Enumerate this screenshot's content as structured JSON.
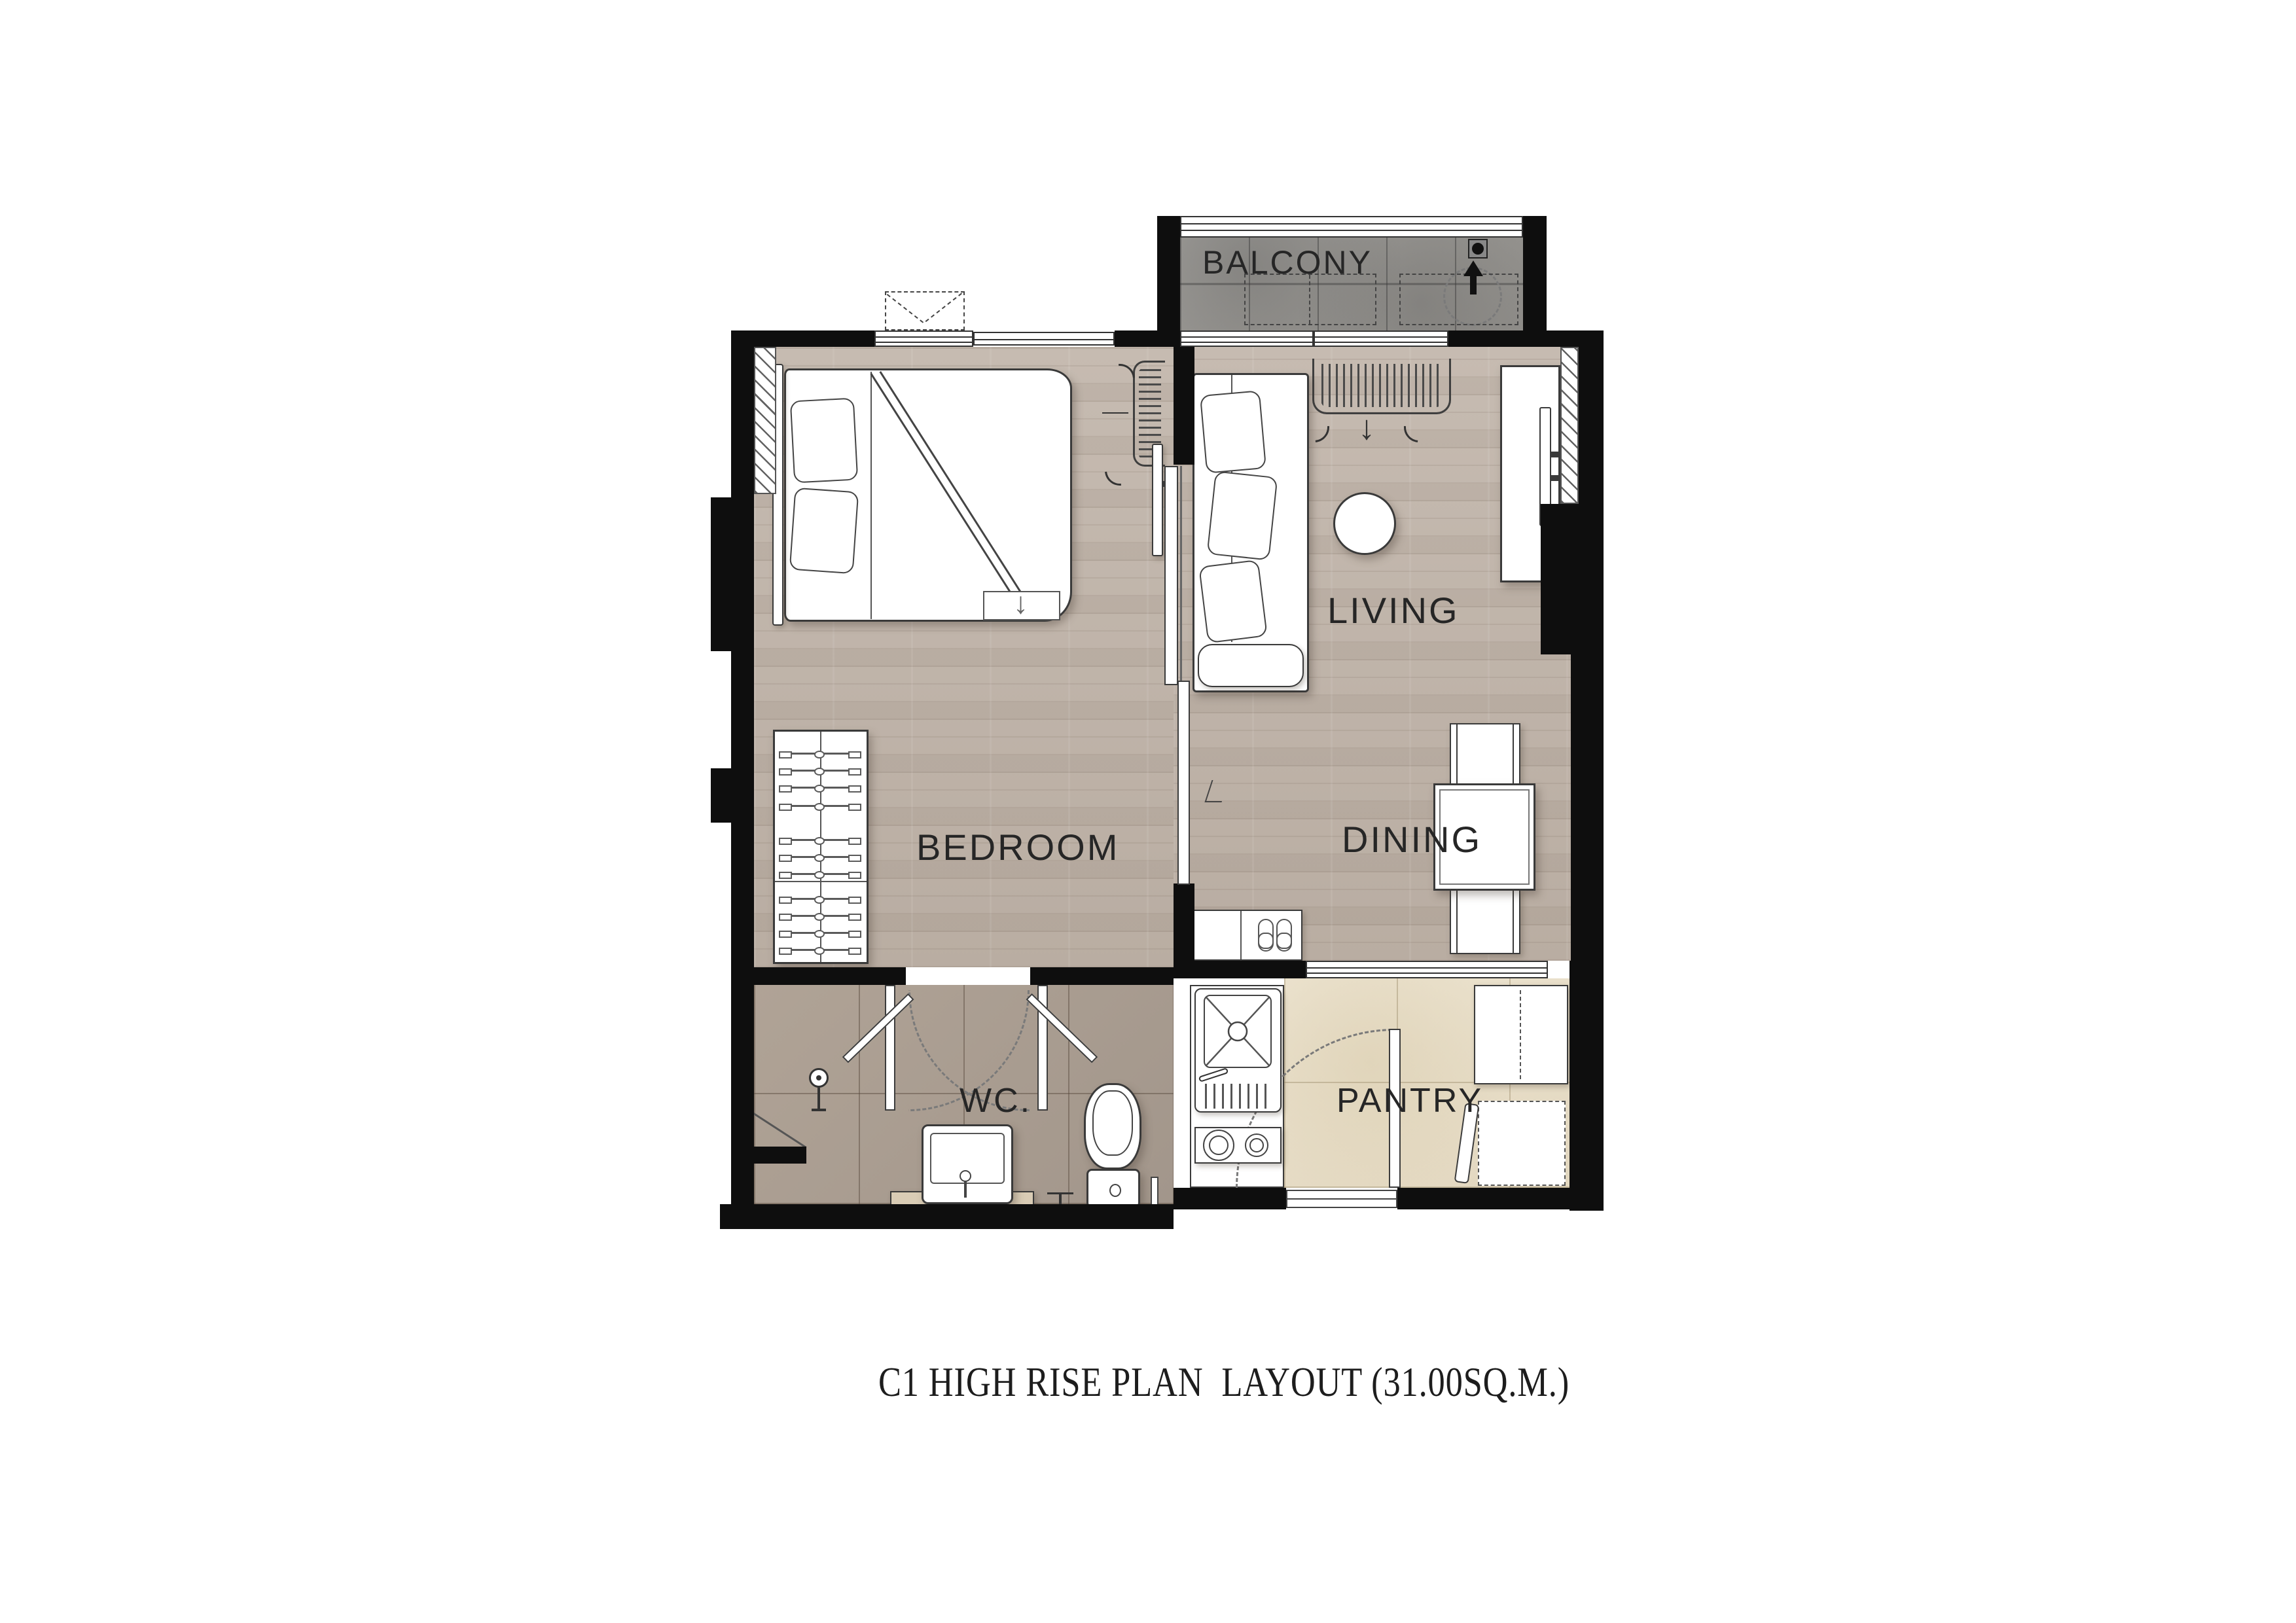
{
  "title": {
    "text": "C1 HIGH RISE PLAN  LAYOUT (31.00SQ.M.)"
  },
  "rooms": {
    "balcony": {
      "label": "BALCONY"
    },
    "living": {
      "label": "LIVING"
    },
    "dining": {
      "label": "DINING"
    },
    "bedroom": {
      "label": "BEDROOM"
    },
    "wc": {
      "label": "WC."
    },
    "pantry": {
      "label": "PANTRY"
    }
  },
  "symbols": {
    "bed_fold_arrow": "↓",
    "vent_arrow": "↓"
  },
  "palette": {
    "wall": "#0e0e0e",
    "wood_floor": "#bfb3a8",
    "balcony_tile": "#999793",
    "wc_tile": "#a99c90",
    "pantry_tile": "#e7decb",
    "furniture_line": "#3a3a3a",
    "label_text": "#262626"
  }
}
